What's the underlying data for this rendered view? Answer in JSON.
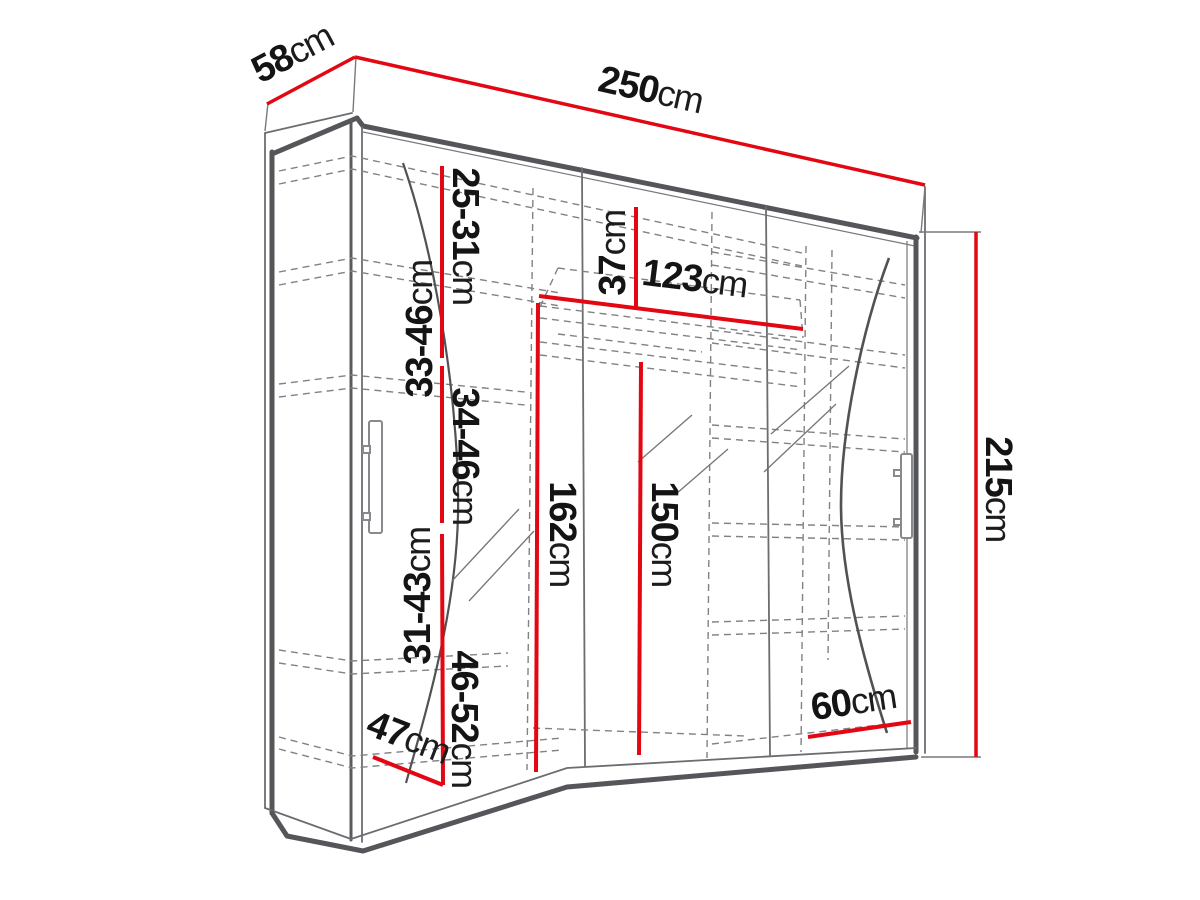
{
  "figure": {
    "type": "furniture-dimension-diagram",
    "subject": "three-door sliding wardrobe with mirrored doors, drawn in perspective",
    "unit": "cm",
    "colors": {
      "dimension_line": "#e30613",
      "outline": "#54565a",
      "dashed_interior": "#818285",
      "label_text": "#141414",
      "background": "#ffffff"
    }
  },
  "dims": {
    "d250": {
      "value": "250",
      "unit": "cm",
      "meaning": "overall width"
    },
    "d58": {
      "value": "58",
      "unit": "cm",
      "meaning": "overall depth"
    },
    "d215": {
      "value": "215",
      "unit": "cm",
      "meaning": "overall height"
    },
    "d2531": {
      "value": "25-31",
      "unit": "cm",
      "meaning": "shelf gap range 1"
    },
    "d3346": {
      "value": "33-46",
      "unit": "cm",
      "meaning": "shelf gap range 2"
    },
    "d3446": {
      "value": "34-46",
      "unit": "cm",
      "meaning": "shelf gap range 3"
    },
    "d3143": {
      "value": "31-43",
      "unit": "cm",
      "meaning": "shelf gap range 4"
    },
    "d4652": {
      "value": "46-52",
      "unit": "cm",
      "meaning": "shelf gap range 5"
    },
    "d37": {
      "value": "37",
      "unit": "cm",
      "meaning": "top section height"
    },
    "d123": {
      "value": "123",
      "unit": "cm",
      "meaning": "hanging section width"
    },
    "d162": {
      "value": "162",
      "unit": "cm",
      "meaning": "left hanging height"
    },
    "d150": {
      "value": "150",
      "unit": "cm",
      "meaning": "middle hanging height"
    },
    "d47": {
      "value": "47",
      "unit": "cm",
      "meaning": "interior depth"
    },
    "d60": {
      "value": "60",
      "unit": "cm",
      "meaning": "right shelf width"
    }
  }
}
